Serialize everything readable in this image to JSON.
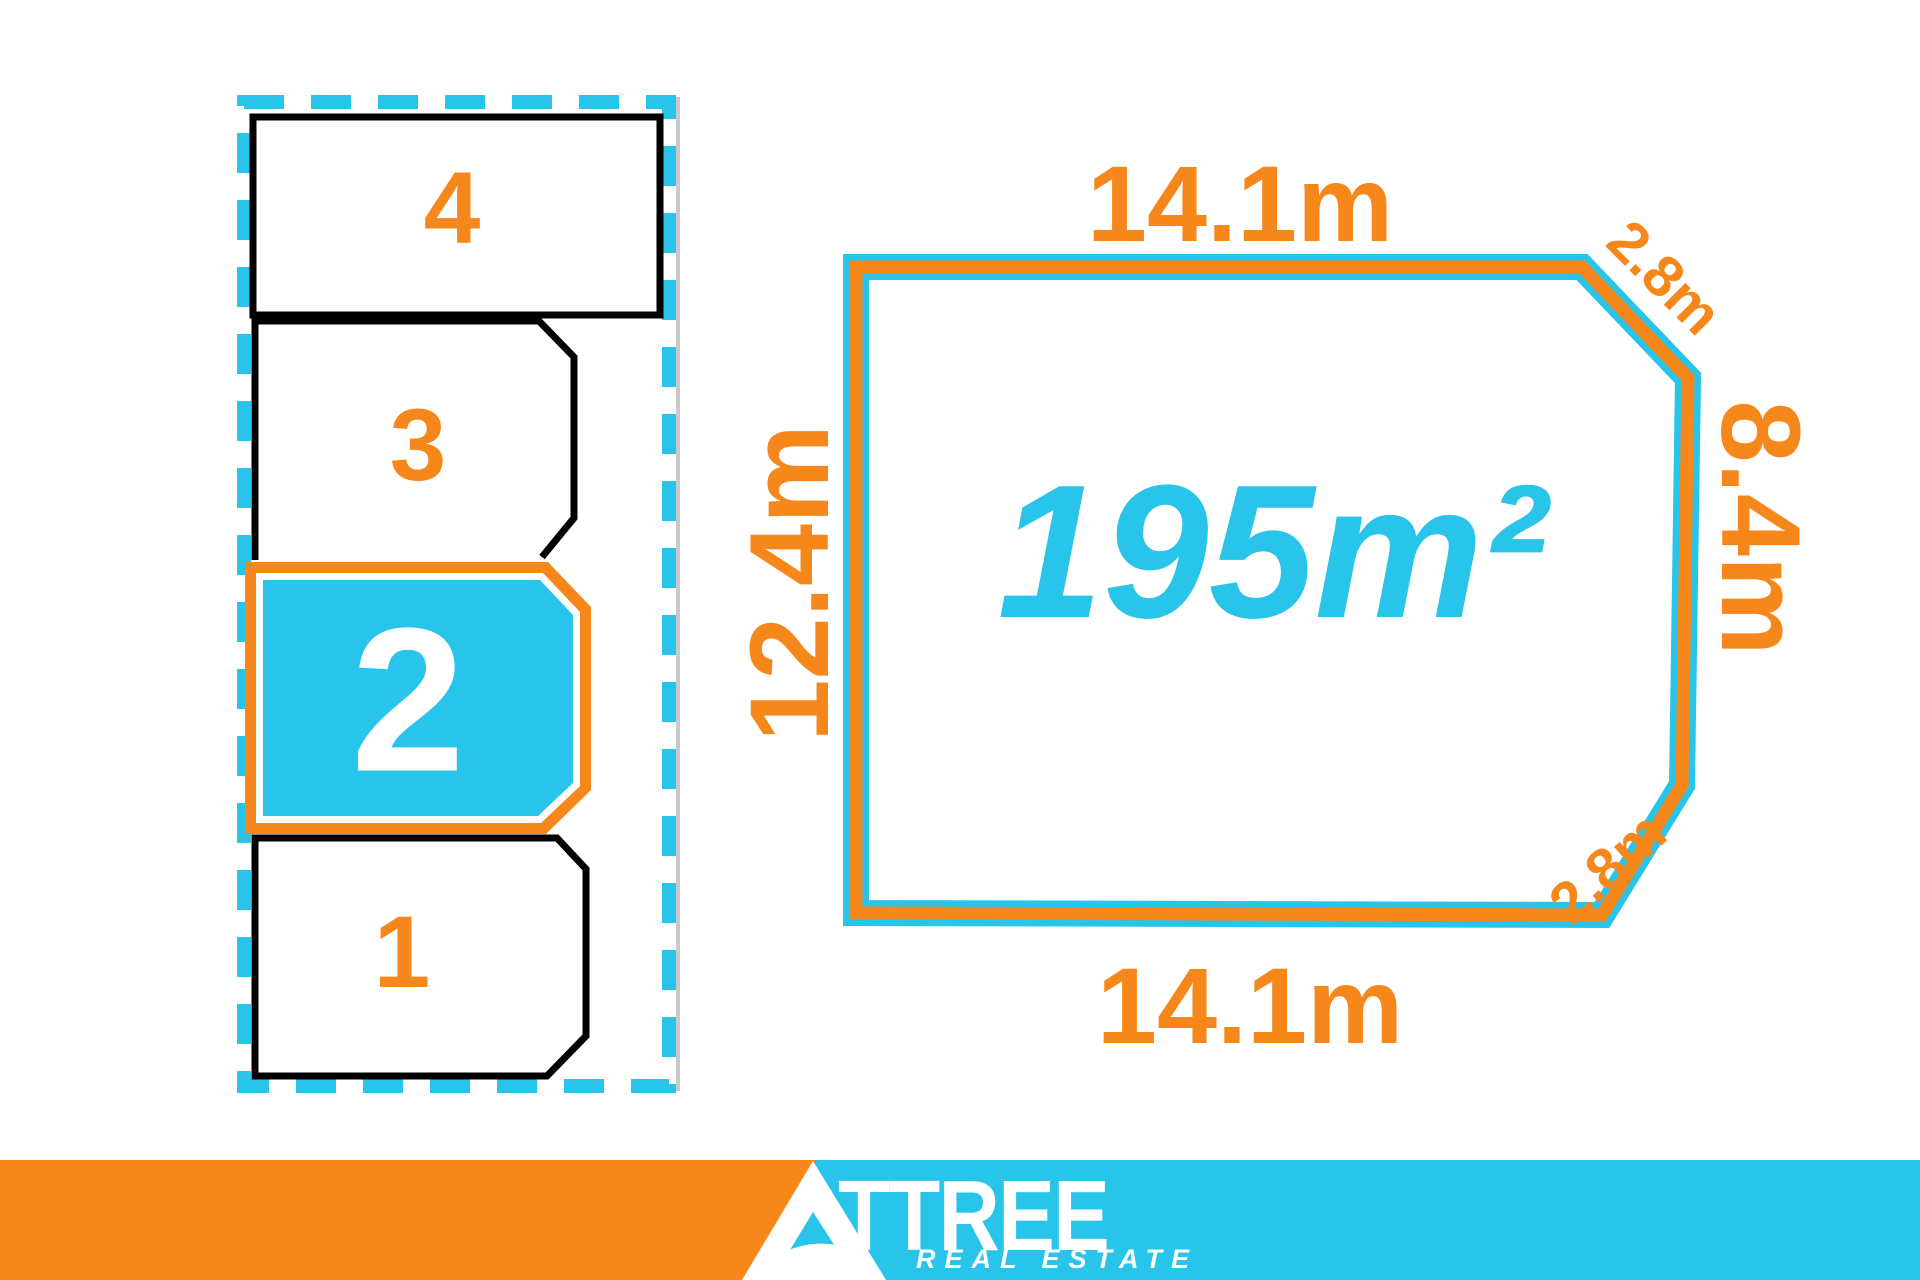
{
  "title": "Lot 2 land sale plan",
  "colors": {
    "orange": "#F6871B",
    "cyan": "#29C4EA",
    "outline_black": "#000000",
    "highlight_number_white": "#FFFFFF",
    "boundary_gray": "#C9C9C9"
  },
  "site_plan": {
    "lots": [
      {
        "number": "4",
        "highlighted": false
      },
      {
        "number": "3",
        "highlighted": false
      },
      {
        "number": "2",
        "highlighted": true
      },
      {
        "number": "1",
        "highlighted": false
      }
    ]
  },
  "lot_diagram": {
    "area_label": "195m²",
    "dimensions": {
      "top": "14.1m",
      "bottom": "14.1m",
      "left": "12.4m",
      "right": "8.4m",
      "corner_top_right": "2.8m",
      "corner_bottom_right": "2.8m"
    }
  },
  "footer": {
    "brand_initial": "A",
    "brand_rest": "TTREE",
    "tagline": "REAL ESTATE"
  }
}
